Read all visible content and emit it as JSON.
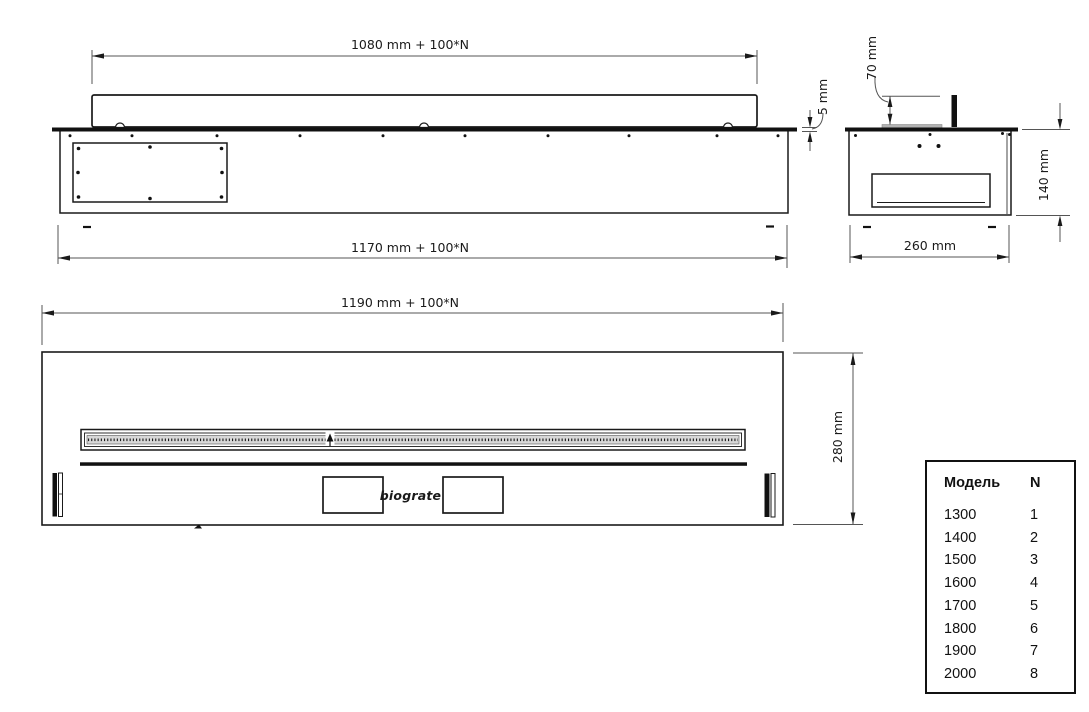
{
  "drawing": {
    "front_view": {
      "top_dim": "1080 mm + 100*N",
      "bottom_dim": "1170 mm + 100*N",
      "flange_thickness_dim": "5 mm"
    },
    "side_view": {
      "burner_height_dim": "70 mm",
      "height_dim": "140 mm",
      "depth_dim": "260 mm"
    },
    "top_view": {
      "width_dim": "1190 mm + 100*N",
      "depth_dim": "280 mm",
      "logo": "biograte"
    },
    "model_table": {
      "headers": [
        "Модель",
        "N"
      ],
      "rows": [
        [
          "1300",
          "1"
        ],
        [
          "1400",
          "2"
        ],
        [
          "1500",
          "3"
        ],
        [
          "1600",
          "4"
        ],
        [
          "1700",
          "5"
        ],
        [
          "1800",
          "6"
        ],
        [
          "1900",
          "7"
        ],
        [
          "2000",
          "8"
        ]
      ]
    },
    "colors": {
      "line": "#1a1a1a",
      "dim_line": "#555555",
      "fill_dark": "#111111",
      "burner_plate_gray": "#b3b3b3",
      "hatch_band": "#d8d8d8"
    }
  }
}
